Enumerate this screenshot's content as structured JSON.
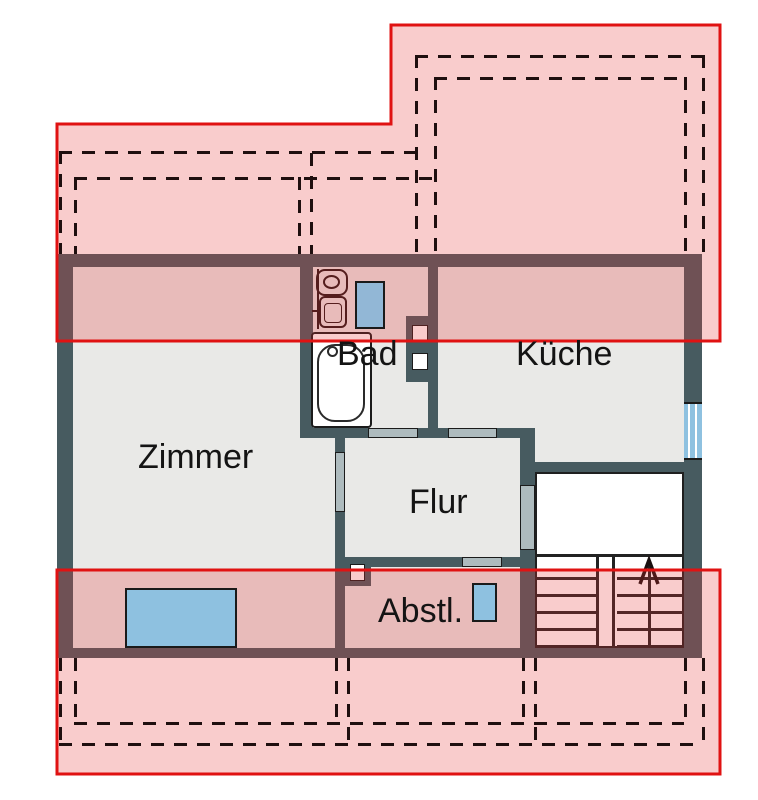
{
  "document": {
    "type": "architectural floor plan with roof outline overlay",
    "language": "de"
  },
  "rooms": [
    {
      "id": "zimmer",
      "label": "Zimmer"
    },
    {
      "id": "bad",
      "label": "Bad"
    },
    {
      "id": "kueche",
      "label": "Küche"
    },
    {
      "id": "flur",
      "label": "Flur"
    },
    {
      "id": "abstl",
      "label": "Abstl."
    }
  ],
  "fixtures": {
    "bathroom": [
      "toilet",
      "sink",
      "bathtub",
      "blue-panel"
    ],
    "stairwell": [
      "two-flight-stairs",
      "up-direction-arrow",
      "landing"
    ],
    "shafts": [
      "bad-kueche-shaft",
      "abstl-corner-shaft"
    ],
    "windows": [
      "right-wall-window",
      "zimmer-knee-window",
      "abstl-panel"
    ]
  },
  "overlay": {
    "meaning": "roof projection (dachgeschoss) zones",
    "fill": "rgba(233,50,50,0.25)",
    "border": "#e01212",
    "dash_color": "#1f0f0f"
  },
  "colors": {
    "wall": "#475b60",
    "floor": "#e9e9e7",
    "door": "#aebbbe",
    "window_blue": "#8ec1e0",
    "background": "#ffffff",
    "label_text": "#141414"
  }
}
